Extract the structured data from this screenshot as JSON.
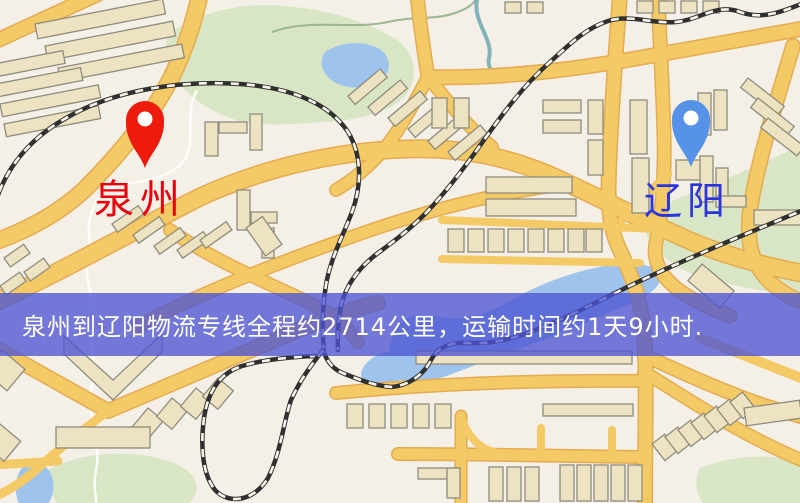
{
  "map": {
    "markers": {
      "origin": {
        "name": "泉州",
        "pin_color": "#ee1a0c",
        "label_color": "#e8000a"
      },
      "destination": {
        "name": "辽阳",
        "pin_color": "#5592e8",
        "label_color": "#2a35dd"
      }
    },
    "banner": {
      "text": "泉州到辽阳物流专线全程约2714公里，运输时间约1天9小时.",
      "background_color": "rgba(77,84,212,0.78)",
      "text_color": "#ffffff"
    },
    "route_info": {
      "origin": "泉州",
      "destination": "辽阳",
      "service": "物流专线",
      "distance": "约2714公里",
      "duration": "约1天9小时"
    },
    "palette": {
      "background": "#f5f0e7",
      "road_fill": "#f4ca67",
      "road_casing": "#e4ab51",
      "building": "#ede2c2",
      "building_outline": "#8e8c7c",
      "park": "#d9e6c5",
      "water": "#9ec3ec",
      "railway": "#303030"
    }
  }
}
